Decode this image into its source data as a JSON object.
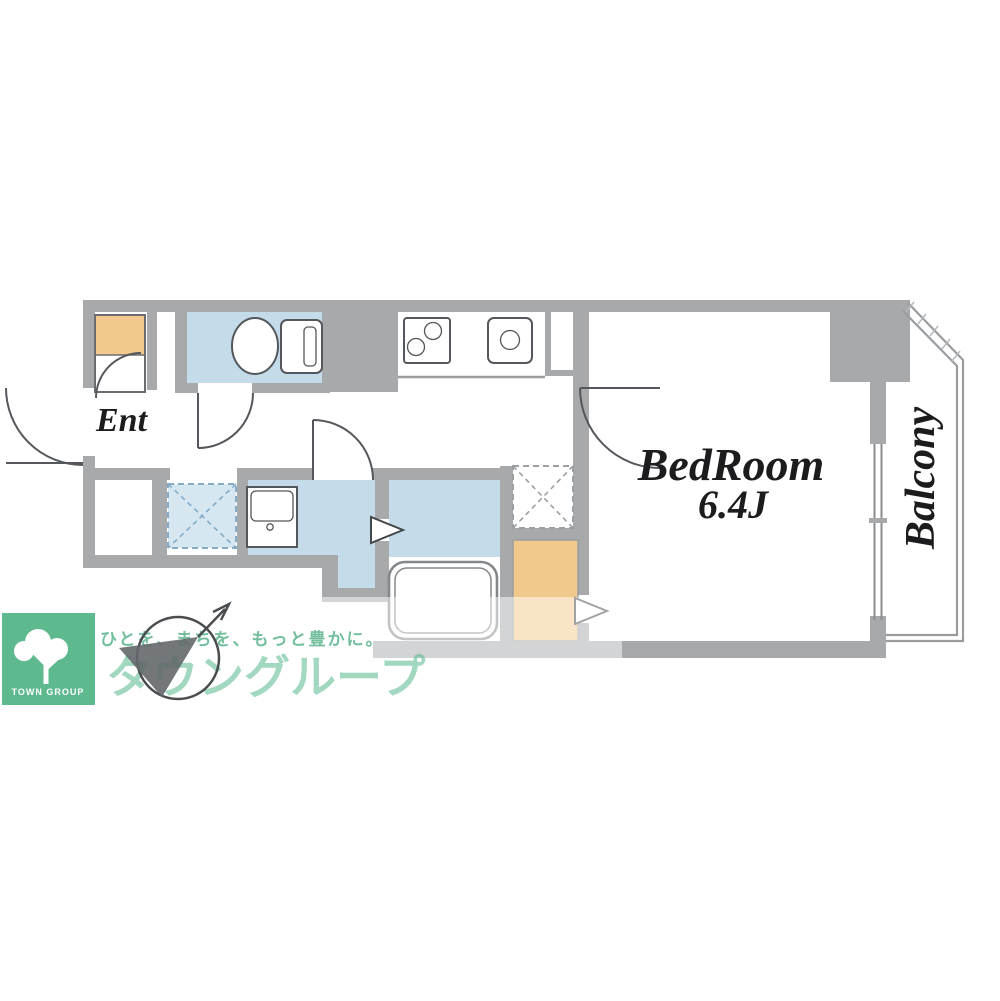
{
  "floorplan": {
    "labels": {
      "entrance": "Ent",
      "bedroom_name": "BedRoom",
      "bedroom_size": "6.4J",
      "balcony": "Balcony"
    },
    "colors": {
      "wall_gray": "#a7a9ab",
      "wet_area_blue": "#c4dbea",
      "storage_orange": "#f2c98c",
      "line_dark": "#54575b"
    },
    "icons": [
      "toilet-icon",
      "stove-icon",
      "kitchen-sink-icon",
      "washbasin-icon",
      "bathtub-icon",
      "washing-machine-space-icon",
      "refrigerator-space-icon",
      "shoe-cabinet-icon",
      "closet-icon",
      "door-arc-icon",
      "window-icon",
      "north-arrow-icon",
      "tree-icon"
    ]
  },
  "branding": {
    "logo_square_text": "TOWN GROUP",
    "brand_name": "タウングループ",
    "slogan": "ひとを、まちを、もっと豊かに。",
    "brand_green": "#5eb98e"
  }
}
